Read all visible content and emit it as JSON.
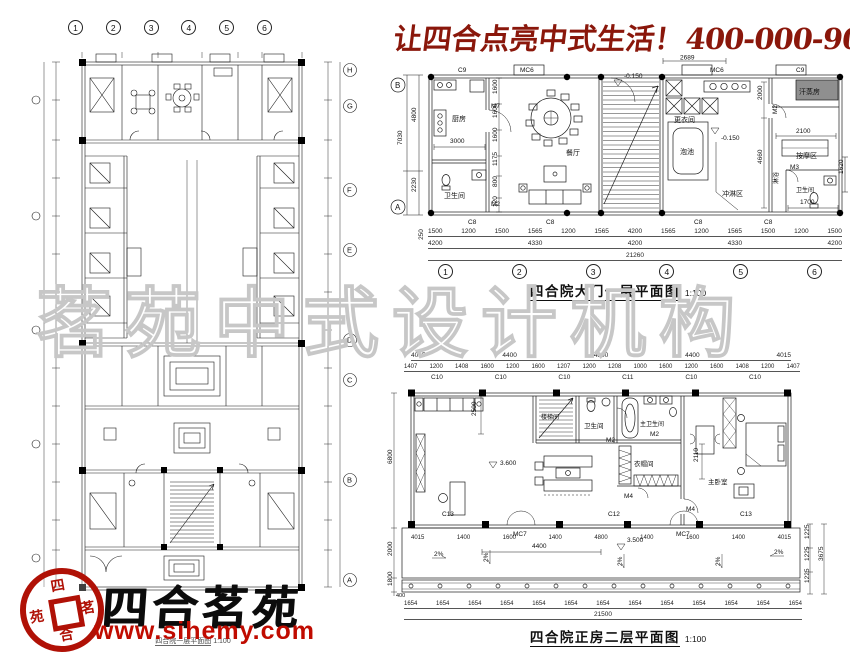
{
  "header": {
    "slogan_cn": "让四合点亮中式生活！",
    "phone": "400-000-9075"
  },
  "watermark": {
    "text": "茗苑中式设计机构"
  },
  "branding": {
    "name": "四合茗苑",
    "website": "www.sihemy.com",
    "seal": {
      "top": "四",
      "right": "茗",
      "bottom": "合",
      "left": "苑"
    }
  },
  "site_plan": {
    "caption": "四合院一层平面图",
    "scale": "1:100",
    "grid_top": [
      "1",
      "2",
      "3",
      "4",
      "5",
      "6"
    ],
    "grid_right": [
      "H",
      "G",
      "F",
      "E",
      "D",
      "C",
      "B",
      "A"
    ]
  },
  "gate_plan": {
    "title": "四合院大门一层平面图",
    "scale": "1:100",
    "grid_bottom": [
      "1",
      "2",
      "3",
      "4",
      "5",
      "6"
    ],
    "grid_left": {
      "top": "B",
      "bottom": "A"
    },
    "rooms": {
      "kitchen": "厨房",
      "bath": "卫生间",
      "dining": "餐厅",
      "changing": "更衣间",
      "pool": "泡池",
      "shower_zone": "冲淋区",
      "sweat_room": "汗蒸房",
      "massage": "按摩区",
      "shower": "淋浴",
      "bath2": "卫生间"
    },
    "doors": {
      "m7": "M7",
      "m2": "M2",
      "m3": "M3",
      "mc6": "MC6",
      "c9": "C9",
      "c8": "C8"
    },
    "levels": {
      "top": "-0.150",
      "shower": "-0.150"
    },
    "dims": {
      "v_total": "7030",
      "v_top": "4800",
      "v_bottom": "2230",
      "kitchen_w": "3000",
      "top_1": "2689",
      "stack": [
        "1600",
        "1600",
        "1600",
        "1175",
        "800",
        "120"
      ],
      "right": {
        "r1": "2000",
        "r2": "2100",
        "r3": "4660",
        "r4": "1620",
        "r5": "1700"
      },
      "row_250": "250",
      "row1": [
        "1500",
        "1200",
        "1500",
        "1565",
        "1200",
        "1565",
        "4200",
        "1565",
        "1200",
        "1565",
        "1500",
        "1200",
        "1500"
      ],
      "row2": [
        "4200",
        "4330",
        "4200",
        "4330",
        "4200"
      ],
      "total": "21260"
    }
  },
  "main_plan": {
    "title": "四合院正房二层平面图",
    "scale": "1:100",
    "rooms": {
      "stair": "楼梯间",
      "bath": "卫生间",
      "master_bath": "主卫生间",
      "cloak": "衣帽间",
      "master_bed": "主卧室"
    },
    "doors": {
      "mc7": "MC7",
      "m2": "M2",
      "m4": "M4",
      "c10": "C10",
      "c11": "C11",
      "c12": "C12",
      "c13": "C13"
    },
    "levels": {
      "indoor": "3.600",
      "terrace": "3.500"
    },
    "slope": "2%",
    "dims": {
      "top_totals": [
        "4015",
        "4400",
        "4800",
        "4400",
        "4015"
      ],
      "top_subs": [
        "1407",
        "1200",
        "1408",
        "1600",
        "1200",
        "1600",
        "1207",
        "1200",
        "1208",
        "1000",
        "1600",
        "1200",
        "1600",
        "1408",
        "1200",
        "1407"
      ],
      "top_windows": [
        "C10",
        "C10",
        "C10",
        "C11",
        "C10",
        "C10"
      ],
      "left": [
        "6800",
        "2000",
        "1800",
        "400"
      ],
      "mid_row": [
        "4015",
        "1400",
        "1600",
        "1400",
        "4800",
        "1400",
        "1600",
        "1400",
        "4015"
      ],
      "terrace_w": "4400",
      "stair_d": "2500",
      "bed_d": "2110",
      "right": [
        "1225",
        "1225",
        "1225"
      ],
      "right_total": "3675",
      "bottom_units": [
        "1654",
        "1654",
        "1654",
        "1654",
        "1654",
        "1654",
        "1654",
        "1654",
        "1654",
        "1654",
        "1654",
        "1654",
        "1654"
      ],
      "bottom_total": "21500"
    }
  }
}
